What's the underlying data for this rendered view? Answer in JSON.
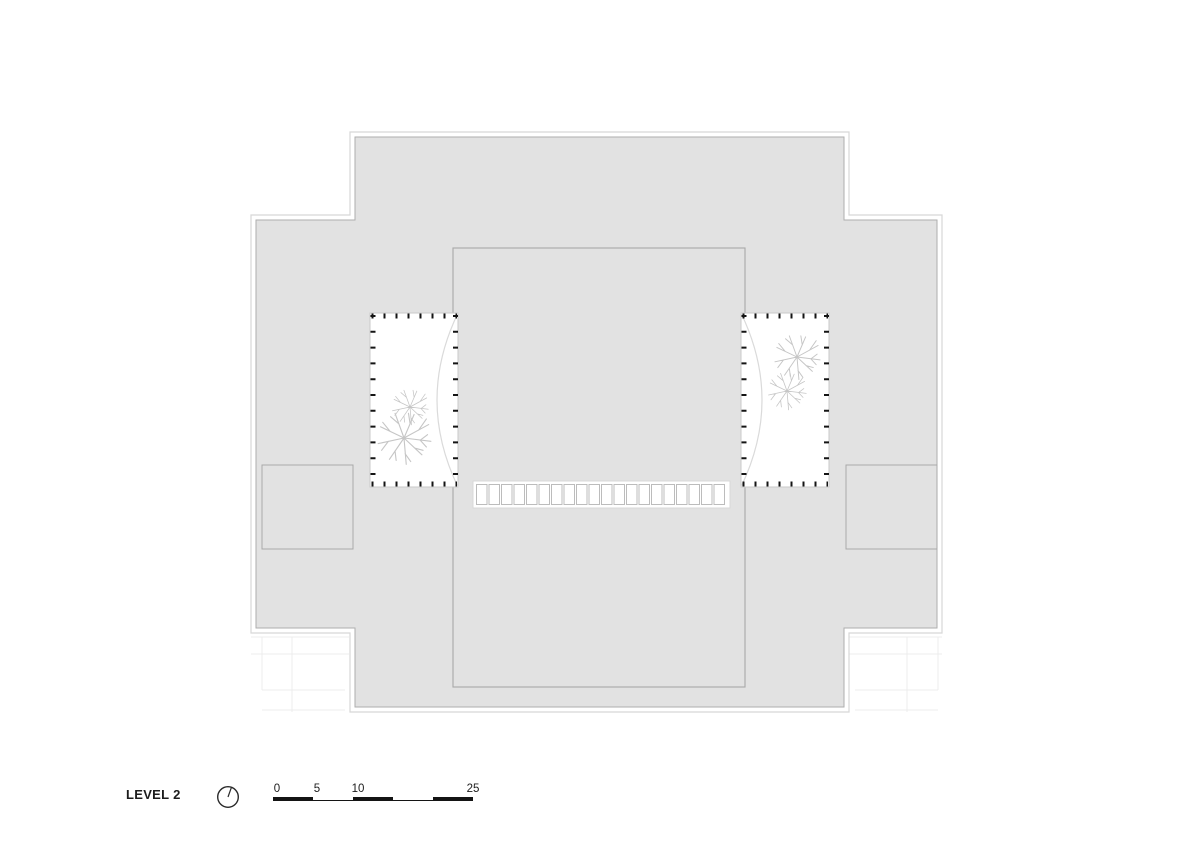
{
  "legend": {
    "level_label": "LEVEL 2",
    "scale_labels": [
      "0",
      "5",
      "10",
      "25"
    ]
  },
  "plan": {
    "colors": {
      "roof_fill": "#e2e2e2",
      "outline": "#d7d7d7",
      "wall_line": "#a9a9a9",
      "tick": "#141414",
      "tree": "#c6c6c6",
      "text": "#1c1c1c"
    },
    "skylight": {
      "cells": 20
    },
    "icons": {
      "north": "north-indicator-icon",
      "tree": "tree-icon"
    }
  }
}
